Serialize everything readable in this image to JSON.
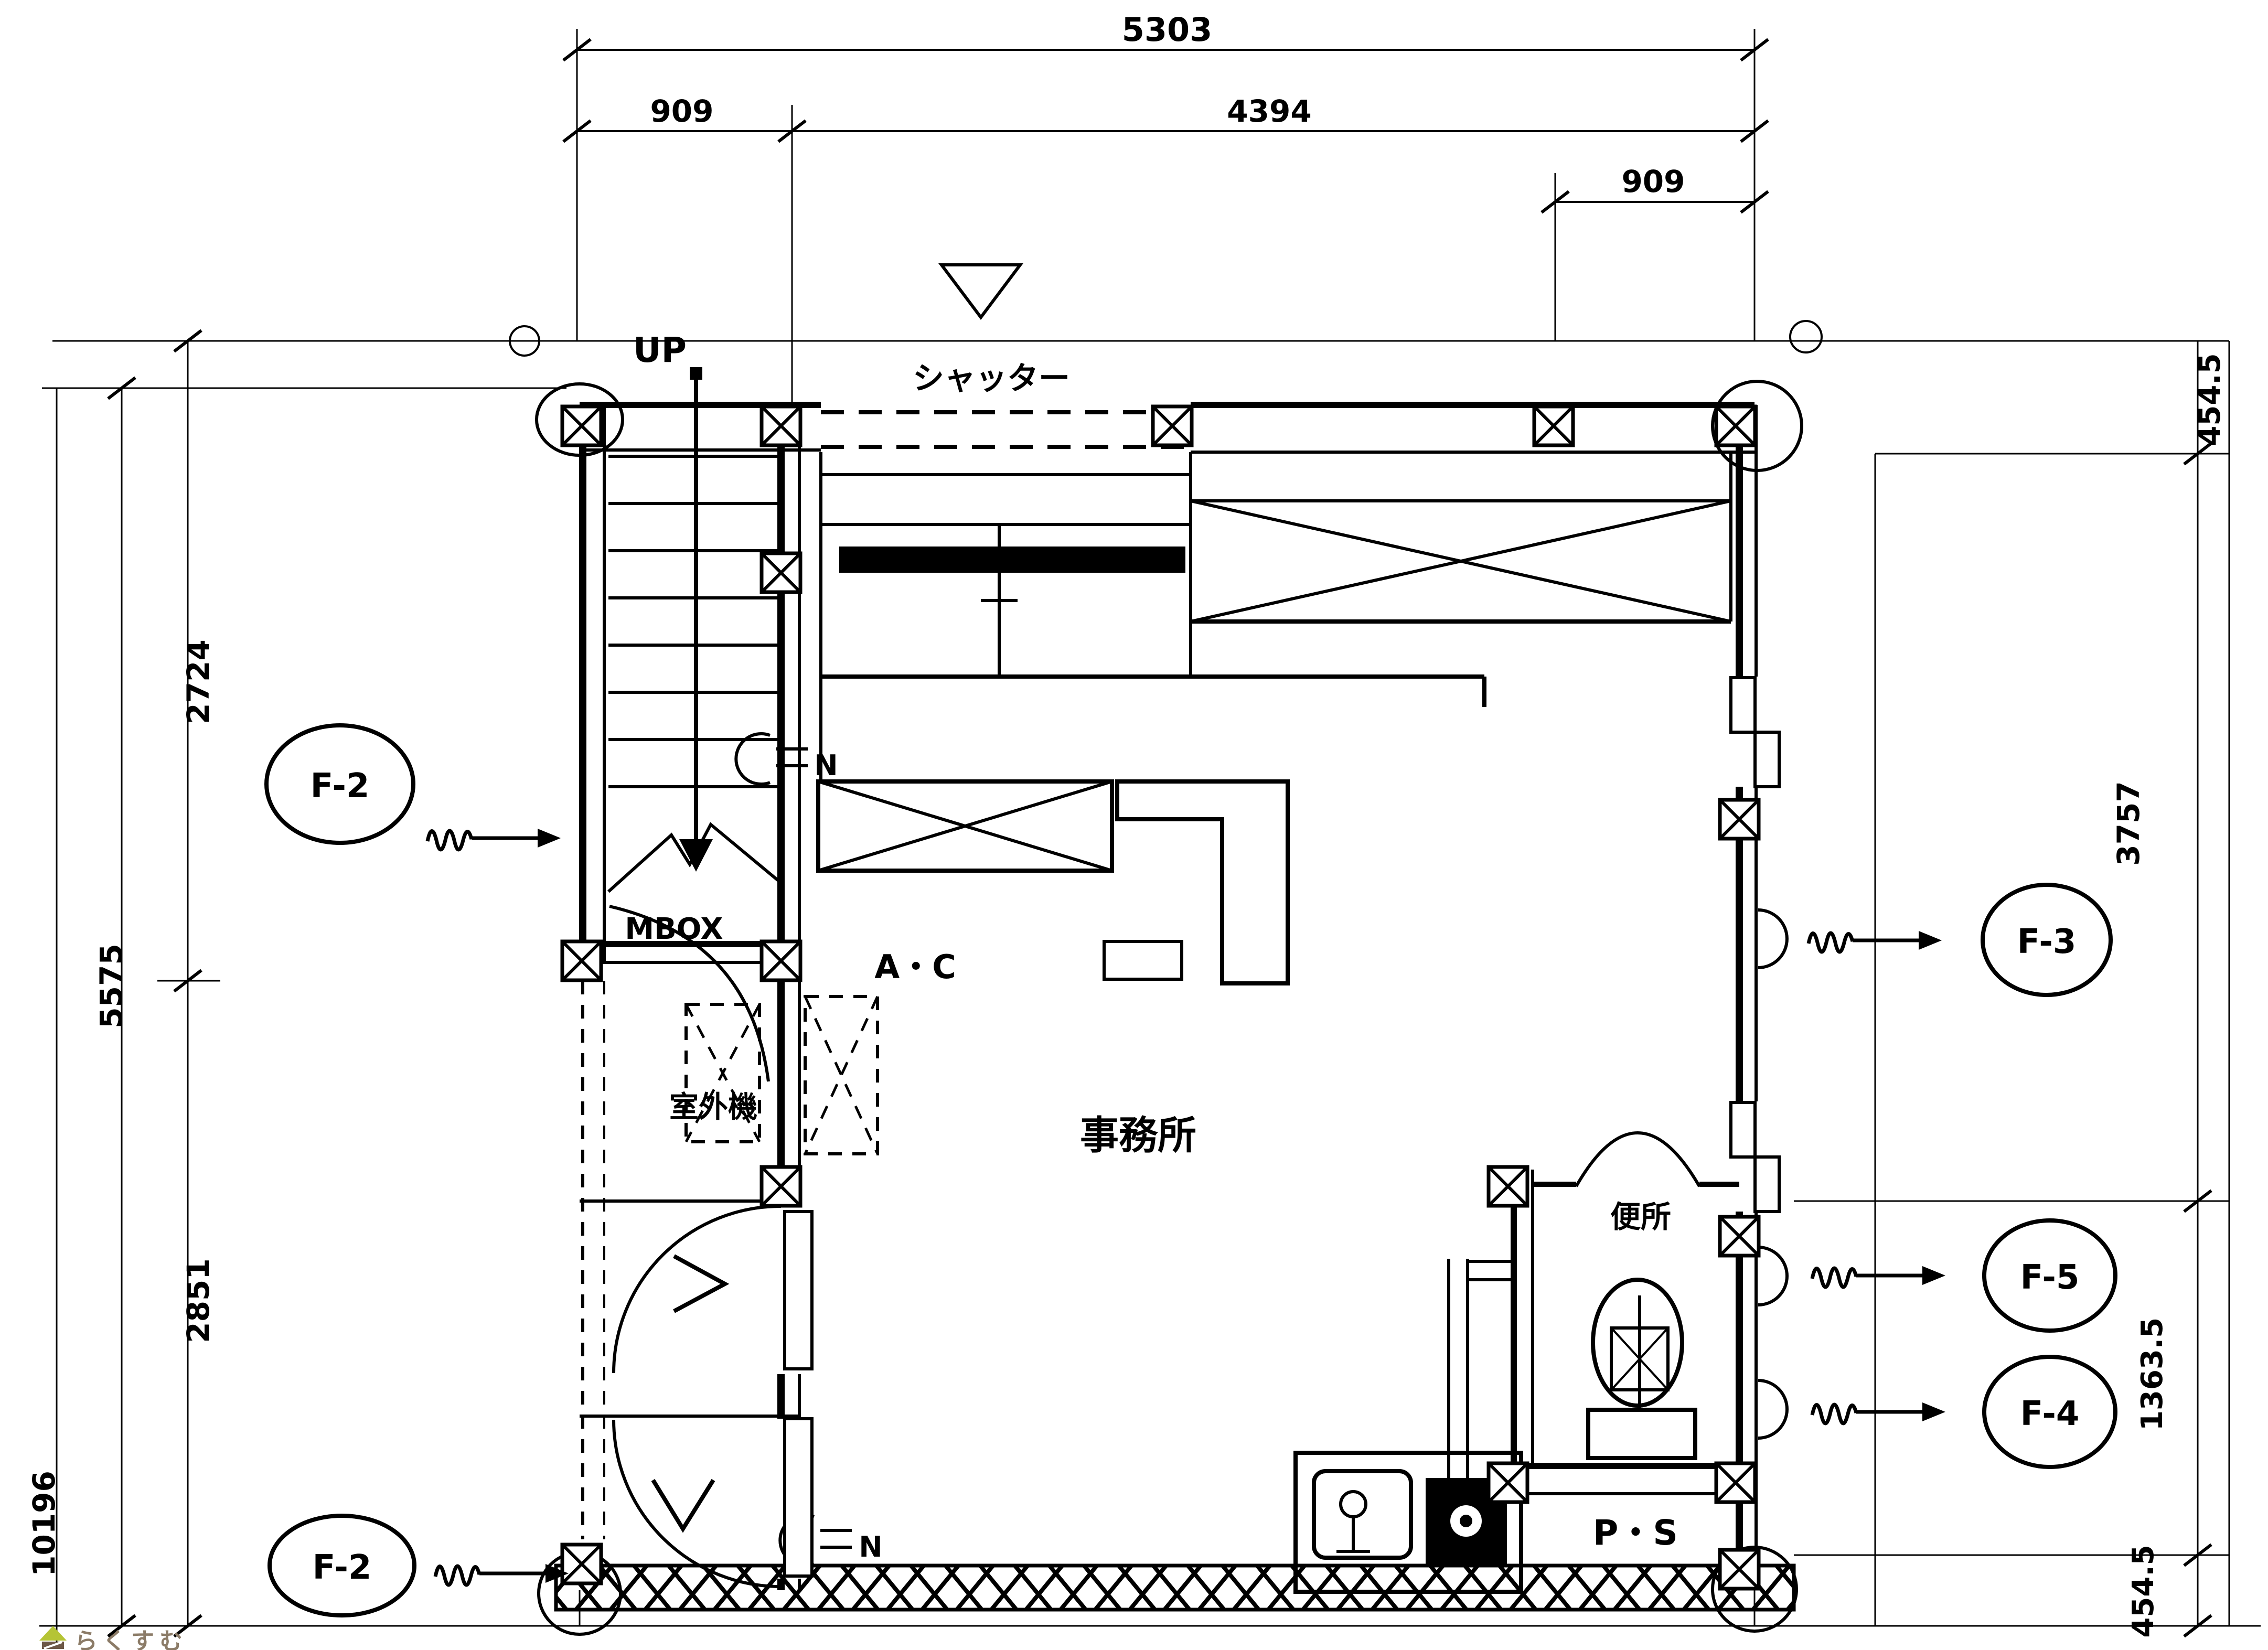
{
  "dims": {
    "top": {
      "overall": "5303",
      "seg_left": "909",
      "seg_main": "4394",
      "seg_right": "909"
    },
    "left": {
      "upper": "2724",
      "sum": "5575",
      "lower": "2851",
      "total": "10196"
    },
    "right": {
      "top": "454.5",
      "main": "3757",
      "lower": "1363.5",
      "bottom": "454.5"
    }
  },
  "labels": {
    "up": "UP",
    "shutter": "シャッター",
    "mbox": "MBOX",
    "ac": "A・C",
    "outdoor_unit": "室外機",
    "office": "事務所",
    "toilet": "便所",
    "pipe_space": "P・S",
    "gas": "N"
  },
  "f_markers": {
    "f2_upper": "F-2",
    "f2_lower": "F-2",
    "f3": "F-3",
    "f5": "F-5",
    "f4": "F-4"
  },
  "watermark": {
    "text": "らくすむ",
    "roof": "#b5c435",
    "body": "#6d5847",
    "ink": "#8b7b67"
  },
  "colors": {
    "ink": "#000000",
    "paper": "#ffffff"
  }
}
